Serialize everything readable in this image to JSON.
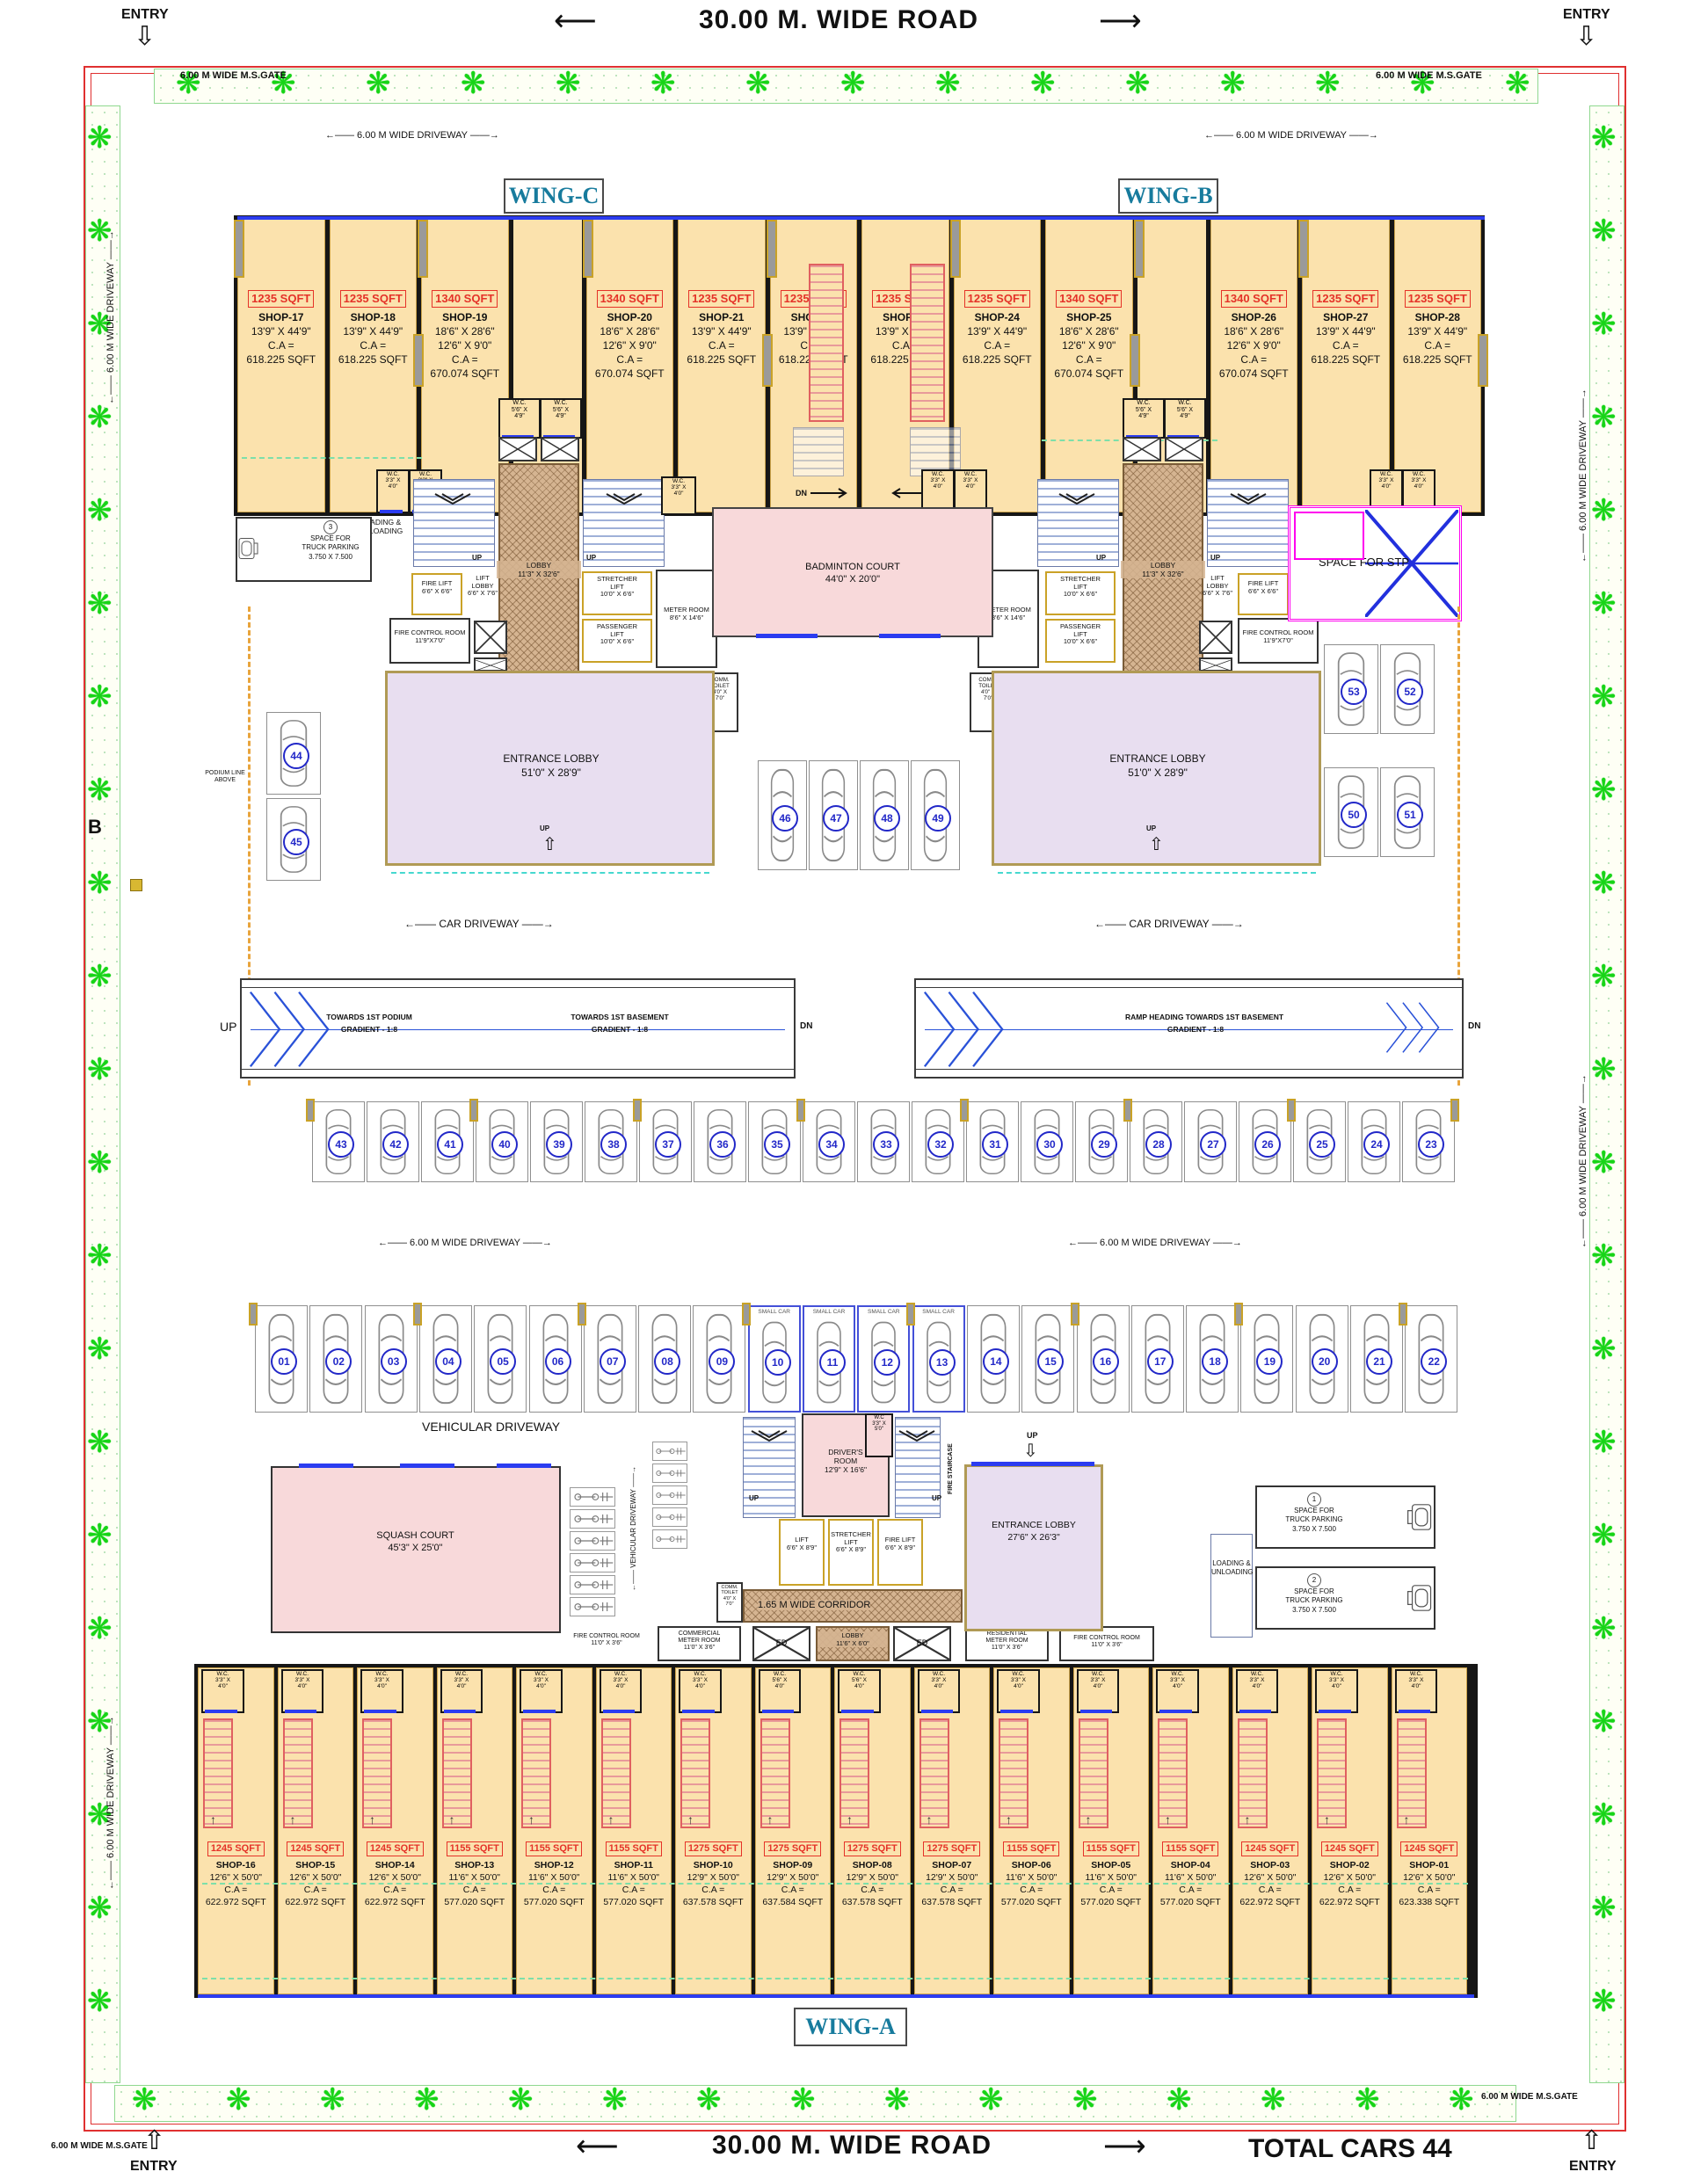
{
  "labels": {
    "road": "30.00 M.  WIDE  ROAD",
    "arrow_l": "⟵",
    "arrow_r": "⟶",
    "entry": "ENTRY",
    "gate": "6.00 M WIDE M.S.GATE",
    "drive": "←—— 6.00 M WIDE DRIVEWAY ——→",
    "car_drive": "←—— CAR  DRIVEWAY ——→",
    "veh_drive": "VEHICULAR  DRIVEWAY",
    "veh_drive_v": "←—— VEHICULAR DRIVEWAY ——→",
    "total_cars": "TOTAL CARS 44",
    "b": "B",
    "podium": [
      "PODIUM LINE",
      "ABOVE"
    ],
    "small_car": "SMALL CAR",
    "up": "UP",
    "dn": "DN"
  },
  "wings": {
    "a": "WING-A",
    "b": "WING-B",
    "c": "WING-C"
  },
  "wc": {
    "w3340": [
      "W.C.",
      "3'3\" X",
      "4'0\""
    ],
    "w5649": [
      "W.C.",
      "5'6\" X",
      "4'9\""
    ],
    "w5640": [
      "W.C.",
      "5'6\" X",
      "4'0\""
    ],
    "w3350": [
      "W.C",
      "3'3\" X",
      "5'0\""
    ]
  },
  "top_shops": [
    {
      "area": "1235 SQFT",
      "name": "SHOP-17",
      "dims": [
        "13'9\" X 44'9\""
      ],
      "ca": "C.A =",
      "ca_val": "618.225 SQFT"
    },
    {
      "area": "1235 SQFT",
      "name": "SHOP-18",
      "dims": [
        "13'9\" X 44'9\""
      ],
      "ca": "C.A =",
      "ca_val": "618.225 SQFT"
    },
    {
      "area": "1340 SQFT",
      "name": "SHOP-19",
      "dims": [
        "18'6\" X 28'6\"",
        "12'6\" X 9'0\""
      ],
      "ca": "C.A =",
      "ca_val": "670.074 SQFT"
    },
    {
      "area": "1340 SQFT",
      "name": "SHOP-20",
      "dims": [
        "18'6\" X 28'6\"",
        "12'6\" X 9'0\""
      ],
      "ca": "C.A =",
      "ca_val": "670.074 SQFT"
    },
    {
      "area": "1235 SQFT",
      "name": "SHOP-21",
      "dims": [
        "13'9\" X 44'9\""
      ],
      "ca": "C.A =",
      "ca_val": "618.225 SQFT"
    },
    {
      "area": "1235 SQFT",
      "name": "SHOP-22",
      "dims": [
        "13'9\" X 44'9\""
      ],
      "ca": "C.A =",
      "ca_val": "618.225 SQFT"
    },
    {
      "area": "1235 SQFT",
      "name": "SHOP-23",
      "dims": [
        "13'9\" X 44'9\""
      ],
      "ca": "C.A =",
      "ca_val": "618.225 SQFT"
    },
    {
      "area": "1235 SQFT",
      "name": "SHOP-24",
      "dims": [
        "13'9\" X 44'9\""
      ],
      "ca": "C.A =",
      "ca_val": "618.225 SQFT"
    },
    {
      "area": "1340 SQFT",
      "name": "SHOP-25",
      "dims": [
        "18'6\" X 28'6\"",
        "12'6\" X 9'0\""
      ],
      "ca": "C.A =",
      "ca_val": "670.074 SQFT"
    },
    {
      "area": "1340 SQFT",
      "name": "SHOP-26",
      "dims": [
        "18'6\" X 28'6\"",
        "12'6\" X 9'0\""
      ],
      "ca": "C.A =",
      "ca_val": "670.074 SQFT"
    },
    {
      "area": "1235 SQFT",
      "name": "SHOP-27",
      "dims": [
        "13'9\" X 44'9\""
      ],
      "ca": "C.A =",
      "ca_val": "618.225 SQFT"
    },
    {
      "area": "1235 SQFT",
      "name": "SHOP-28",
      "dims": [
        "13'9\" X 44'9\""
      ],
      "ca": "C.A =",
      "ca_val": "618.225 SQFT"
    }
  ],
  "bottom_shops": [
    {
      "area": "1245 SQFT",
      "name": "SHOP-16",
      "dims": [
        "12'6\" X 50'0\""
      ],
      "ca": "C.A =",
      "ca_val": "622.972 SQFT",
      "wc": "w3340"
    },
    {
      "area": "1245 SQFT",
      "name": "SHOP-15",
      "dims": [
        "12'6\" X 50'0\""
      ],
      "ca": "C.A =",
      "ca_val": "622.972 SQFT",
      "wc": "w3340"
    },
    {
      "area": "1245 SQFT",
      "name": "SHOP-14",
      "dims": [
        "12'6\" X 50'0\""
      ],
      "ca": "C.A =",
      "ca_val": "622.972 SQFT",
      "wc": "w3340"
    },
    {
      "area": "1155 SQFT",
      "name": "SHOP-13",
      "dims": [
        "11'6\" X 50'0\""
      ],
      "ca": "C.A =",
      "ca_val": "577.020 SQFT",
      "wc": "w3340"
    },
    {
      "area": "1155 SQFT",
      "name": "SHOP-12",
      "dims": [
        "11'6\" X 50'0\""
      ],
      "ca": "C.A =",
      "ca_val": "577.020 SQFT",
      "wc": "w3340"
    },
    {
      "area": "1155 SQFT",
      "name": "SHOP-11",
      "dims": [
        "11'6\" X 50'0\""
      ],
      "ca": "C.A =",
      "ca_val": "577.020 SQFT",
      "wc": "w3340"
    },
    {
      "area": "1275 SQFT",
      "name": "SHOP-10",
      "dims": [
        "12'9\" X 50'0\""
      ],
      "ca": "C.A =",
      "ca_val": "637.578 SQFT",
      "wc": "w3340"
    },
    {
      "area": "1275 SQFT",
      "name": "SHOP-09",
      "dims": [
        "12'9\" X 50'0\""
      ],
      "ca": "C.A =",
      "ca_val": "637.584 SQFT",
      "wc": "w5640"
    },
    {
      "area": "1275 SQFT",
      "name": "SHOP-08",
      "dims": [
        "12'9\" X 50'0\""
      ],
      "ca": "C.A =",
      "ca_val": "637.578 SQFT",
      "wc": "w5640"
    },
    {
      "area": "1275 SQFT",
      "name": "SHOP-07",
      "dims": [
        "12'9\" X 50'0\""
      ],
      "ca": "C.A =",
      "ca_val": "637.578 SQFT",
      "wc": "w3340"
    },
    {
      "area": "1155 SQFT",
      "name": "SHOP-06",
      "dims": [
        "11'6\" X 50'0\""
      ],
      "ca": "C.A =",
      "ca_val": "577.020 SQFT",
      "wc": "w3340"
    },
    {
      "area": "1155 SQFT",
      "name": "SHOP-05",
      "dims": [
        "11'6\" X 50'0\""
      ],
      "ca": "C.A =",
      "ca_val": "577.020 SQFT",
      "wc": "w3340"
    },
    {
      "area": "1155 SQFT",
      "name": "SHOP-04",
      "dims": [
        "11'6\" X 50'0\""
      ],
      "ca": "C.A =",
      "ca_val": "577.020 SQFT",
      "wc": "w3340"
    },
    {
      "area": "1245 SQFT",
      "name": "SHOP-03",
      "dims": [
        "12'6\" X 50'0\""
      ],
      "ca": "C.A =",
      "ca_val": "622.972 SQFT",
      "wc": "w3340"
    },
    {
      "area": "1245 SQFT",
      "name": "SHOP-02",
      "dims": [
        "12'6\" X 50'0\""
      ],
      "ca": "C.A =",
      "ca_val": "622.972 SQFT",
      "wc": "w3340"
    },
    {
      "area": "1245 SQFT",
      "name": "SHOP-01",
      "dims": [
        "12'6\" X 50'0\""
      ],
      "ca": "C.A =",
      "ca_val": "623.338 SQFT",
      "wc": "w3340"
    }
  ],
  "core_top": {
    "lobby": [
      "LOBBY",
      "11'3\" X 32'6\""
    ],
    "fire_lift": [
      "FIRE LIFT",
      "6'6\" X 6'6\""
    ],
    "lift_lobby": [
      "LIFT",
      "LOBBY",
      "6'6\" X 7'6\""
    ],
    "fcr": [
      "FIRE CONTROL ROOM",
      "11'9\"X7'0\""
    ],
    "stretcher": [
      "STRETCHER",
      "LIFT",
      "10'0\" X 6'6\""
    ],
    "passenger": [
      "PASSENGER",
      "LIFT",
      "10'0\" X 6'6\""
    ],
    "meter": [
      "METER ROOM",
      "8'6\" X 14'6\""
    ],
    "loading": [
      "LOADING &",
      "UNLOADING"
    ],
    "comm_toilet": [
      "COMM.",
      "TOILET",
      "4'0\" X",
      "7'0\""
    ]
  },
  "core_bot": {
    "drivers": [
      "DRIVER'S",
      "ROOM",
      "12'9\" X 16'6\""
    ],
    "fire_staircase": "FIRE STAIRCASE",
    "lift": [
      "LIFT",
      "6'6\" X 8'9\""
    ],
    "stretcher": [
      "STRETCHER",
      "LIFT",
      "6'6\" X 8'9\""
    ],
    "fire_lift": [
      "FIRE LIFT",
      "6'6\" X 8'9\""
    ],
    "corridor": "1.65 M WIDE CORRIDOR",
    "lobby": [
      "LOBBY",
      "11'6\" X 6'0\""
    ],
    "res_meter": [
      "RESIDENTIAL",
      "METER ROOM",
      "11'0\" X 3'6\""
    ],
    "com_meter": [
      "COMMERCIAL",
      "METER ROOM",
      "11'0\" X 3'6\""
    ],
    "fcr": [
      "FIRE CONTROL ROOM",
      "11'0\" X 3'6\""
    ],
    "ed": "ED"
  },
  "rooms": {
    "badminton": [
      "BADMINTON COURT",
      "44'0\" X 20'0\""
    ],
    "squash": [
      "SQUASH COURT",
      "45'3\" X 25'0\""
    ],
    "ent_top": [
      "ENTRANCE LOBBY",
      "51'0\" X 28'9\""
    ],
    "ent_bot": [
      "ENTRANCE LOBBY",
      "27'6\" X 26'3\""
    ],
    "stp": "SPACE FOR STP"
  },
  "truck": {
    "n1": "1",
    "n2": "2",
    "n3": "3",
    "l1": "SPACE FOR",
    "l2": "TRUCK PARKING",
    "l3": "3.750 X 7.500"
  },
  "ramp": {
    "up": "UP",
    "dn": "DN",
    "p1": "TOWARDS 1ST PODIUM",
    "p2": "GRADIENT - 1:8",
    "b1": "TOWARDS 1ST BASEMENT",
    "b2": "GRADIENT - 1:8",
    "r1": "RAMP HEADING TOWARDS 1ST BASEMENT",
    "r2": "GRADIENT - 1:8"
  },
  "parking": {
    "mid": [
      "43",
      "42",
      "41",
      "40",
      "39",
      "38",
      "37",
      "36",
      "35",
      "34",
      "33",
      "32",
      "31",
      "30",
      "29",
      "28",
      "27",
      "26",
      "25",
      "24",
      "23"
    ],
    "low": [
      "01",
      "02",
      "03",
      "04",
      "05",
      "06",
      "07",
      "08",
      "09",
      "10",
      "11",
      "12",
      "13",
      "14",
      "15",
      "16",
      "17",
      "18",
      "19",
      "20",
      "21",
      "22"
    ],
    "small_range": [
      "10",
      "11",
      "12",
      "13"
    ],
    "top_left": [
      "44",
      "45"
    ],
    "top_mid": [
      "46",
      "47",
      "48",
      "49"
    ],
    "right_top": [
      "53",
      "52"
    ],
    "right_bot": [
      "50",
      "51"
    ]
  },
  "colors": {
    "shop_fill": "#fbe2ad",
    "court_pink": "#f8d9da",
    "lobby_lavender": "#e8def0",
    "hatch_brown": "#d5b491",
    "accent_red": "#e53228",
    "accent_blue": "#2228c8",
    "wing_teal": "#177b9d",
    "tree_green": "#17d417",
    "border_red": "#e03030",
    "stp_magenta": "#ff00ee",
    "podium_orange": "#e8a43c"
  }
}
